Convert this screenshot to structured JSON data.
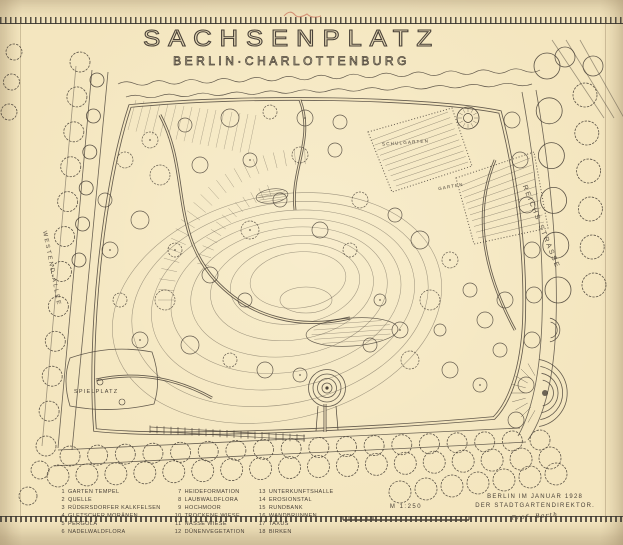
{
  "sheet": {
    "title": "SACHSENPLATZ",
    "subtitle": "BERLIN·CHARLOTTENBURG"
  },
  "streets": {
    "left": "WESTEND-ALLEE",
    "right": "REICHS·STRASSE"
  },
  "plan_labels": {
    "playground": "SPIELPLATZ",
    "school_garden": "SCHULGARTEN",
    "garden": "GARTEN"
  },
  "legend": {
    "columns": [
      [
        {
          "num": "1",
          "label": "GARTEN TEMPEL"
        },
        {
          "num": "2",
          "label": "QUELLE"
        },
        {
          "num": "3",
          "label": "RÜDERSDORFER KALKFELSEN"
        },
        {
          "num": "4",
          "label": "GLETSCHER MORÄNEN"
        },
        {
          "num": "5",
          "label": "PERGOLA"
        },
        {
          "num": "6",
          "label": "NADELWALDFLORA"
        }
      ],
      [
        {
          "num": "7",
          "label": "HEIDEFORMATION"
        },
        {
          "num": "8",
          "label": "LAUBWALDFLORA"
        },
        {
          "num": "9",
          "label": "HOCHMOOR"
        },
        {
          "num": "10",
          "label": "TROCKENE WIESE"
        },
        {
          "num": "11",
          "label": "NASSE WIESE"
        },
        {
          "num": "12",
          "label": "DÜNENVEGETATION"
        }
      ],
      [
        {
          "num": "13",
          "label": "UNTERKUNFTSHALLE"
        },
        {
          "num": "14",
          "label": "EROSIONSTAL"
        },
        {
          "num": "15",
          "label": "RUNDBANK"
        },
        {
          "num": "16",
          "label": "WANDBRUNNEN"
        },
        {
          "num": "17",
          "label": "TAXUS"
        },
        {
          "num": "18",
          "label": "BIRKEN"
        }
      ]
    ]
  },
  "scale": {
    "label": "M 1:250"
  },
  "imprint": {
    "line1": "BERLIN IM JANUAR 1928",
    "line2": "DER STADTGARTENDIREKTOR.",
    "signature": "Prof. Barth"
  },
  "colors": {
    "paper": "#f4e6bf",
    "ink": "#4a4238",
    "red": "#c0523f"
  }
}
